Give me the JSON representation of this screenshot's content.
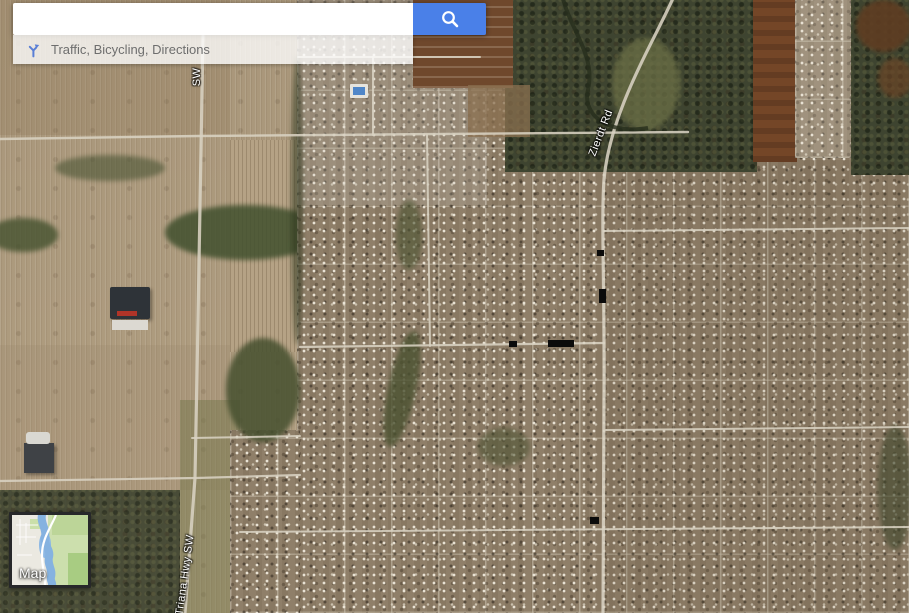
{
  "app": {
    "name": "Google Maps",
    "view_mode": "satellite"
  },
  "search": {
    "value": "",
    "button_icon": "magnifier",
    "quick_links": {
      "text": "Traffic, Bicycling, Directions",
      "icon": "directions-arrow"
    }
  },
  "map": {
    "road_labels": [
      {
        "id": "zierdt",
        "text": "Zierdt Rd"
      },
      {
        "id": "hwy-partial",
        "text": "SW"
      },
      {
        "id": "triana",
        "text": "Triana Hwy SW"
      }
    ],
    "toggle": {
      "label": "Map",
      "preview": "map-mode-thumbnail"
    }
  },
  "colors": {
    "accent_blue": "#4a80e8",
    "quick_link_icon_blue": "#5a7fd6",
    "road_label_text": "#ffffff",
    "minimap_water": "#85b2e0",
    "minimap_green": "#ccdfad"
  }
}
